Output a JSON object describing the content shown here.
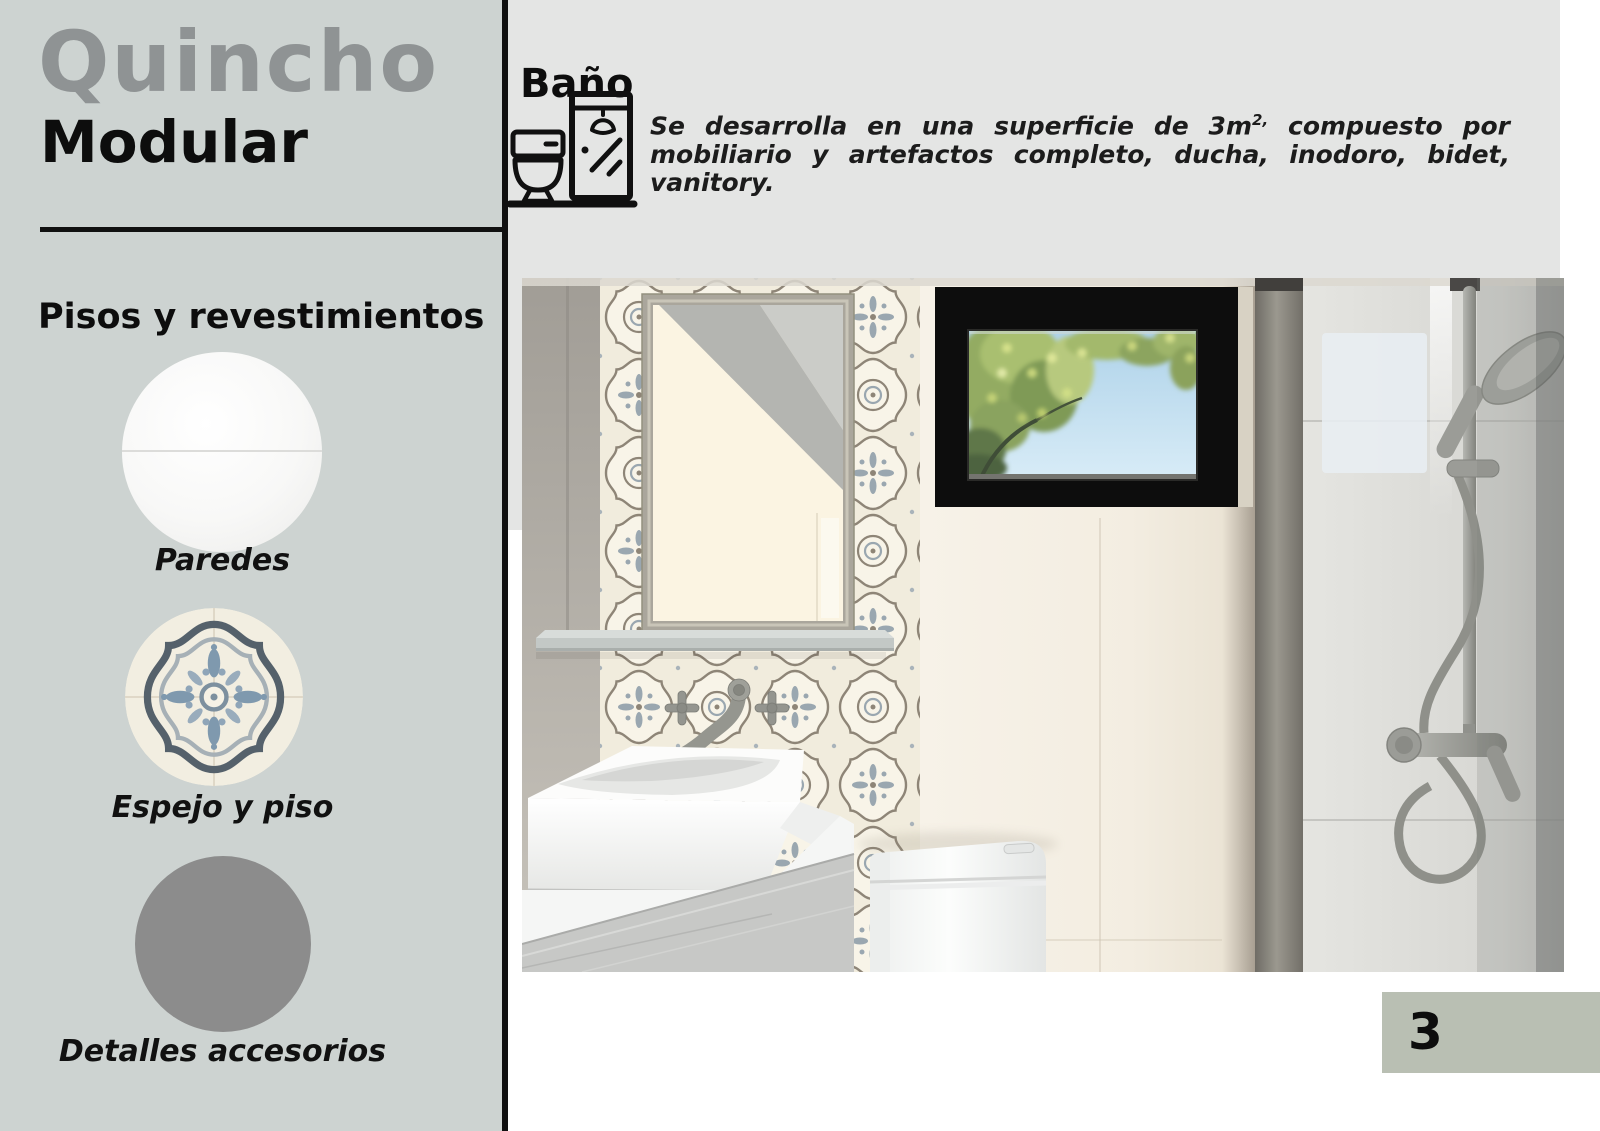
{
  "sidebar": {
    "title_primary": "Quincho",
    "title_secondary": "Modular",
    "section_heading": "Pisos y revestimientos",
    "swatches": [
      {
        "label": "Paredes",
        "icon": "wall-texture-swatch"
      },
      {
        "label": "Espejo y piso",
        "icon": "patterned-tile-swatch"
      },
      {
        "label": "Detalles accesorios",
        "icon": "gray-accessory-swatch"
      }
    ]
  },
  "content": {
    "heading": "Baño",
    "icon": "toilet-shower-icon",
    "description": {
      "before_sup": "Se desarrolla en una superficie de 3m",
      "sup": "2,",
      "after_sup": " compuesto por mobiliario y artefactos completo, ducha, inodoro, bidet, vanitory."
    }
  },
  "page_number": "3",
  "colors": {
    "sidebar_bg": "#cdd3d1",
    "header_bg": "#e4e5e4",
    "rule": "#101010",
    "title_gray": "#8f9394",
    "page_box_bg": "#b9bfb3",
    "swatch_gray": "#8c8c8c",
    "tile_blue": "#7f99ae",
    "tile_taupe": "#8e8577"
  }
}
